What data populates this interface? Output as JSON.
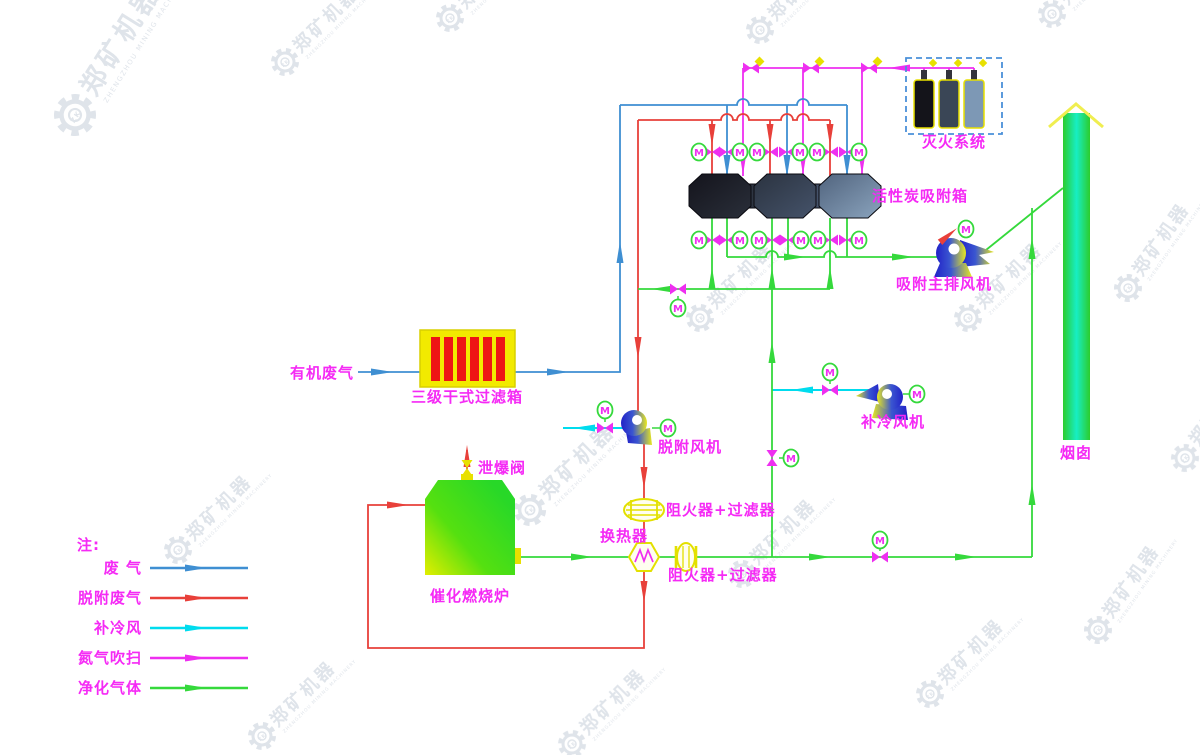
{
  "diagram": {
    "title_hint": "organic waste gas adsorption and catalytic combustion process flow",
    "motor_letter": "M",
    "labels": {
      "organic_waste_gas": "有机废气",
      "filter_box": "三级干式过滤箱",
      "adsorption_box": "活性炭吸附箱",
      "fire_system": "灭火系统",
      "main_fan": "吸附主排风机",
      "desorption_fan": "脱附风机",
      "cooling_fan": "补冷风机",
      "flame_arrester_filter": "阻火器+过滤器",
      "heat_exchanger": "换热器",
      "furnace": "催化燃烧炉",
      "relief_valve": "泄爆阀",
      "chimney": "烟囱"
    },
    "legend": {
      "title": "注:",
      "items": [
        {
          "label": "废 气",
          "color": "#3f8fd2"
        },
        {
          "label": "脱附废气",
          "color": "#e8403a"
        },
        {
          "label": "补冷风",
          "color": "#00dcee"
        },
        {
          "label": "氮气吹扫",
          "color": "#ee2ff0"
        },
        {
          "label": "净化气体",
          "color": "#35d93c"
        }
      ]
    },
    "colors": {
      "waste_gas_line": "#3f8fd2",
      "desorption_line": "#e8403a",
      "cooling_line": "#00dcee",
      "nitrogen_line": "#ee2ff0",
      "clean_gas_line": "#35d93c",
      "label_text": "#f52af5",
      "equipment_yellow": "#e3e000",
      "filter_stripe_red": "#ee1515"
    },
    "watermark": {
      "cn": "郑矿机器",
      "en": "ZHENGZHOU MINING MACHINERY",
      "zk": "ZK"
    }
  }
}
